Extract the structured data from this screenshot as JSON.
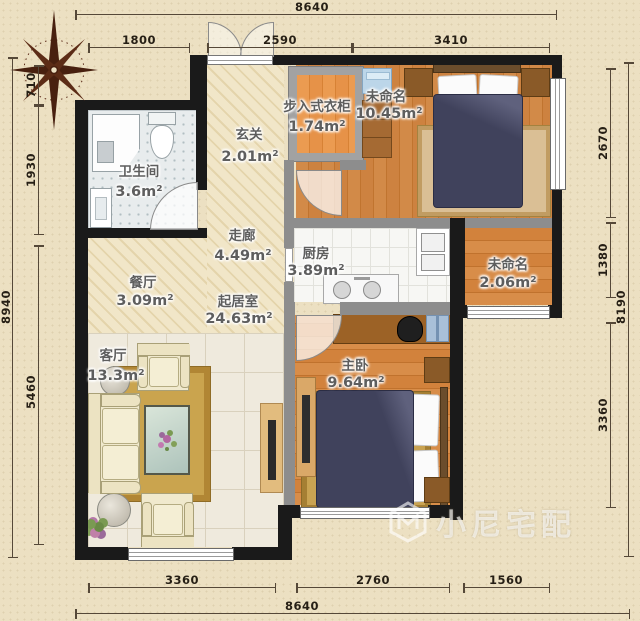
{
  "rooms": {
    "bathroom": {
      "name": "卫生间",
      "area": "3.6m²"
    },
    "entry": {
      "name": "玄关",
      "area": "2.01m²"
    },
    "closet": {
      "name": "步入式衣柜",
      "area": "1.74m²"
    },
    "bedroom2": {
      "name": "未命名",
      "area": "10.45m²"
    },
    "corridor": {
      "name": "走廊",
      "area": "4.49m²"
    },
    "kitchen": {
      "name": "厨房",
      "area": "3.89m²"
    },
    "balcony": {
      "name": "未命名",
      "area": "2.06m²"
    },
    "dining": {
      "name": "餐厅",
      "area": "3.09m²"
    },
    "livingroom": {
      "name": "起居室",
      "area": "24.63m²"
    },
    "lounge": {
      "name": "客厅",
      "area": "13.3m²"
    },
    "master": {
      "name": "主卧",
      "area": "9.64m²"
    }
  },
  "dimensions": {
    "top_total": "8640",
    "top": [
      "1800",
      "2590",
      "3410"
    ],
    "left_total": "8940",
    "left": [
      "710",
      "1930",
      "5460"
    ],
    "right_total": "8190",
    "right": [
      "2670",
      "1380",
      "3360"
    ],
    "bottom": [
      "3360",
      "2760",
      "1560"
    ],
    "bottom_total": "8640"
  },
  "watermark": {
    "text": "小尼宅配"
  },
  "colors": {
    "wall": "#1a1a1a",
    "interior_wall": "#8d8d8d",
    "wood_floor": "#d28a48",
    "bedding": "#40425c",
    "rug_gold": "#caa44e",
    "background": "#ece0c2"
  }
}
